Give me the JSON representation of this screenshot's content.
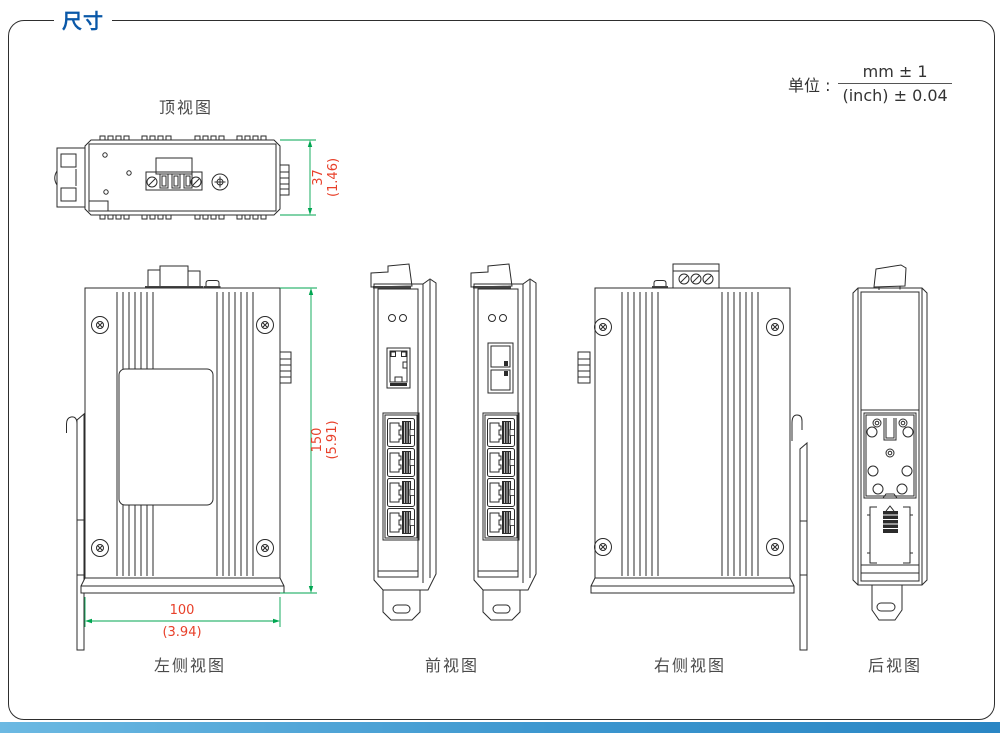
{
  "page": {
    "title": "尺寸"
  },
  "unit_note": {
    "prefix": "单位 :",
    "numerator": "mm ± 1",
    "denominator": "(inch) ± 0.04"
  },
  "views": {
    "top": {
      "label": "顶视图"
    },
    "left_side": {
      "label": "左侧视图"
    },
    "front": {
      "label": "前视图"
    },
    "right_side": {
      "label": "右侧视图"
    },
    "back": {
      "label": "后视图"
    }
  },
  "dimensions": {
    "depth": {
      "mm": "37",
      "inch": "(1.46)"
    },
    "height": {
      "mm": "150",
      "inch": "(5.91)"
    },
    "width": {
      "mm": "100",
      "inch": "(3.94)"
    }
  },
  "colors": {
    "title_blue": "#0a58a8",
    "dimension_line_green": "#00a651",
    "dimension_text_red": "#e8402a",
    "drawing_line": "#2b2b2b",
    "footer_blue": "#3d97cf"
  }
}
